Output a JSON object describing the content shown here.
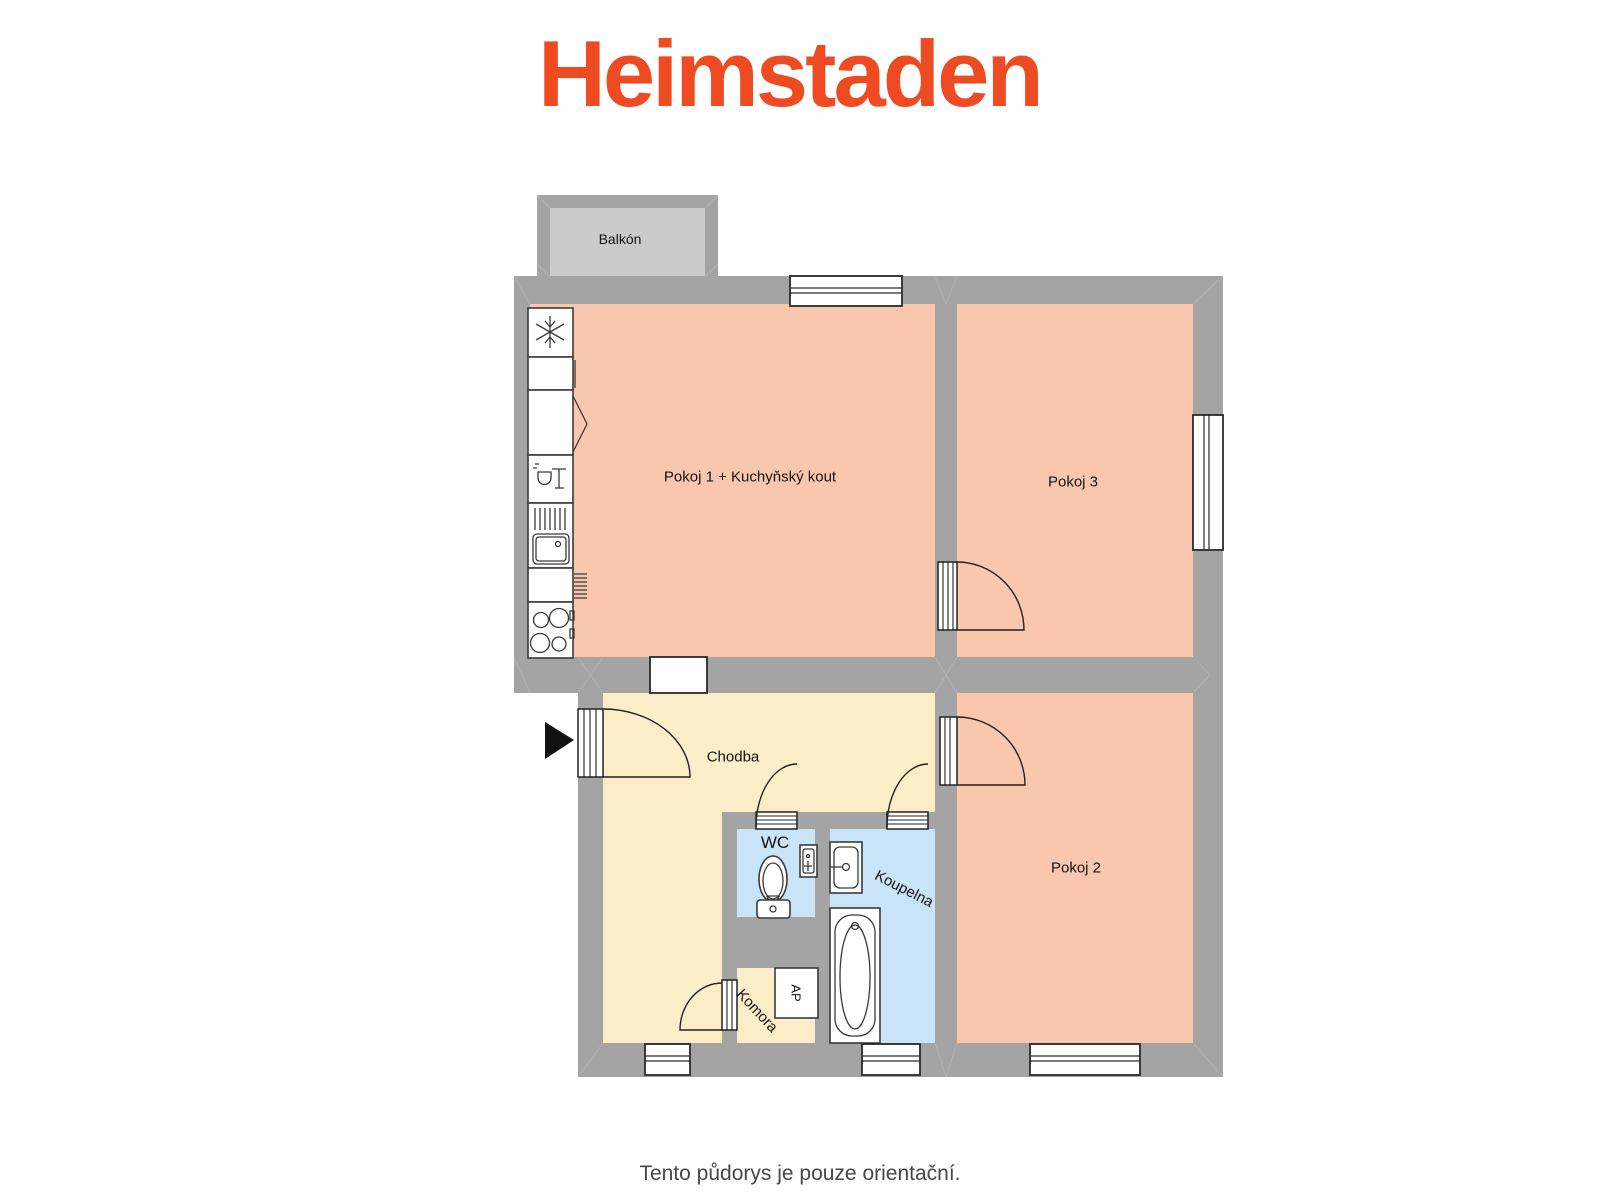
{
  "logo": {
    "text": "Heimstaden"
  },
  "caption": "Tento půdorys je pouze orientační.",
  "rooms": {
    "balcony": "Balkón",
    "room1": "Pokoj 1 + Kuchyňský kout",
    "room3": "Pokoj 3",
    "hall": "Chodba",
    "wc": "WC",
    "bathroom": "Koupelna",
    "room2": "Pokoj 2",
    "pantry": "Komora",
    "washer": "AP"
  },
  "icons": [
    "fridge-snowflake-icon",
    "dishwasher-icon",
    "kitchen-sink-icon",
    "stove-burners-icon",
    "corner-cabinet-icon",
    "toilet-icon",
    "wc-washbasin-icon",
    "bath-washbasin-icon",
    "bathtub-icon",
    "entrance-arrow-icon",
    "door-swing-arc",
    "window-symbol",
    "wall-opening"
  ],
  "colors": {
    "wall": "#a4a4a4",
    "balcony_floor": "#cbcbcb",
    "room_salmon": "#f9c7ad",
    "hall_cream": "#fcedc9",
    "bath_blue": "#c9e3f7",
    "outline": "#3a3a3a",
    "seam": "#b9b9b9",
    "logo": "#ef4b23",
    "caption": "#474747",
    "label": "#141414"
  }
}
